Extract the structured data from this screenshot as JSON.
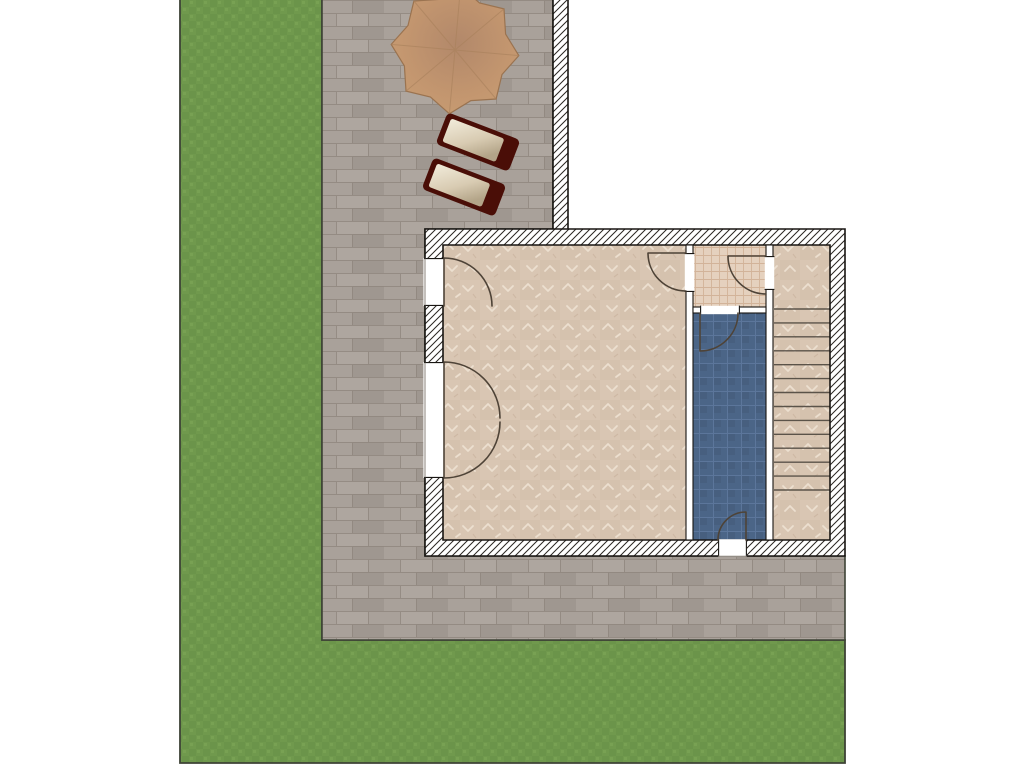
{
  "plan": {
    "type": "residential-site-floor-plan",
    "areas": [
      {
        "name": "lawn"
      },
      {
        "name": "paved-patio"
      },
      {
        "name": "main-room"
      },
      {
        "name": "vestibule"
      },
      {
        "name": "blue-room"
      },
      {
        "name": "stair-landing"
      },
      {
        "name": "staircase"
      }
    ],
    "furniture": [
      {
        "name": "parasol"
      },
      {
        "name": "sun-lounger"
      },
      {
        "name": "sun-lounger"
      }
    ],
    "door_count": 6,
    "stairs": {
      "x1": 774,
      "x2": 830,
      "y_start": 309,
      "y_end": 490,
      "tread_lines": 14
    }
  },
  "palette": {
    "page_bg": "#ffffff",
    "site_border": "#3e4336",
    "grass": "#70994d",
    "grass_dark": "#668f47",
    "grass_light": "#7da757",
    "paving": "#a9a19a",
    "paving_dark": "#9b938c",
    "paving_light": "#b4aba3",
    "paving_line": "#8f867d",
    "outline": "#181512",
    "wall_fill": "#ffffff",
    "wall_hatch": "#2a2622",
    "floor_main": "#d9c6b3",
    "floor_main_shade": "#d0bca8",
    "floor_main_mark": "#f0e4d5",
    "floor_main_mark2": "#c4ad97",
    "floor_vest": "#e5d1be",
    "floor_vest_line": "#d2b399",
    "floor_blue": "#4b6587",
    "floor_blue_line": "#5c769b",
    "floor_blue_shade": "#000000",
    "stair_line": "#5b5349",
    "door_line": "#4e4337",
    "threshold_line": "#8a8279",
    "parasol_center": "#b2886a",
    "parasol_mid": "#c3966f",
    "parasol_edge": "#cba174",
    "parasol_stroke": "#9a7350",
    "parasol_rib": "#a9815c",
    "lounger_frame": "#4a0e07",
    "cushion_a": "#f2ecdb",
    "cushion_b": "#d8cbb2",
    "cushion_c": "#b3a488"
  }
}
